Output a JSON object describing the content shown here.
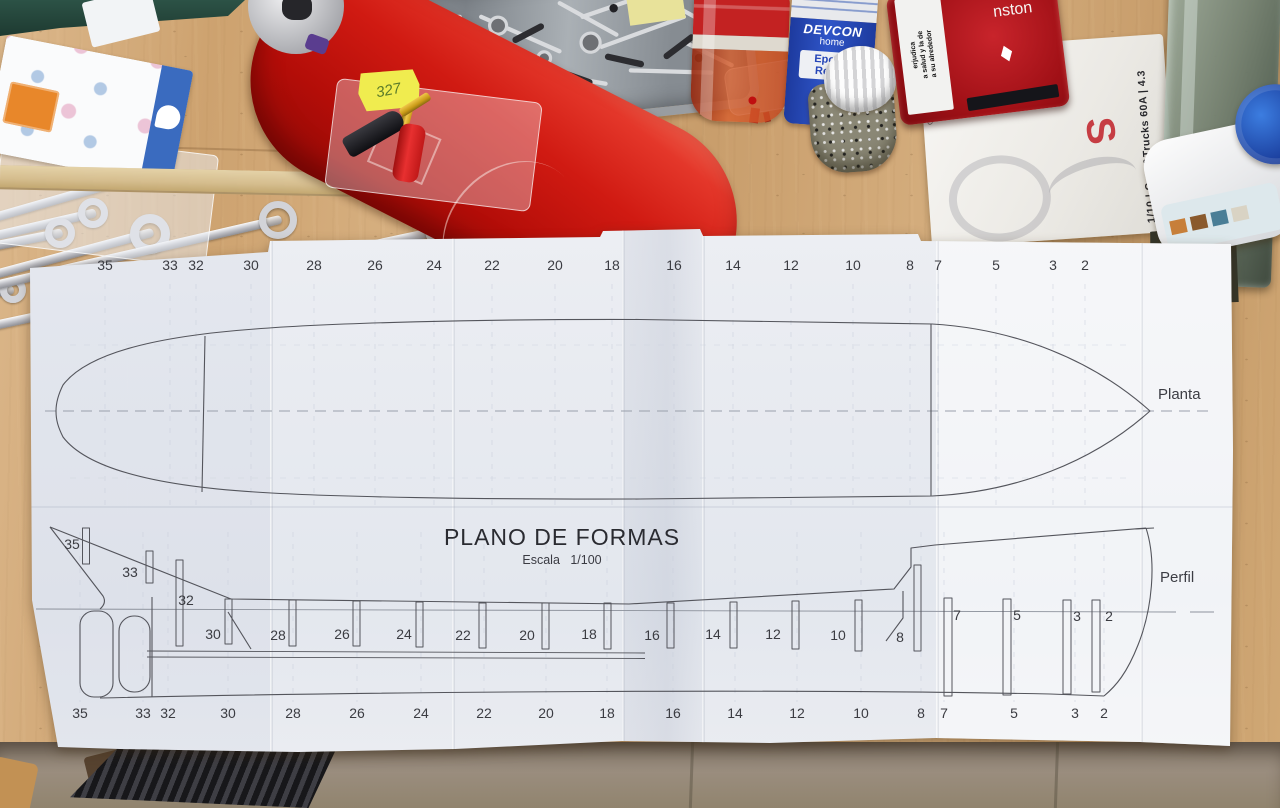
{
  "plan": {
    "title": "PLANO DE FORMAS",
    "scale_label": "Escala   1/100",
    "top_view_label": "Planta",
    "side_view_label": "Perfil",
    "stations": [
      "35",
      "33",
      "32",
      "30",
      "28",
      "26",
      "24",
      "22",
      "20",
      "18",
      "16",
      "14",
      "12",
      "10",
      "8",
      "7",
      "5",
      "3",
      "2"
    ]
  },
  "bench": {
    "sticky_note_text": "327",
    "epoxy_bottle": {
      "brand": "DEVCON",
      "line": "home",
      "product1": "Epoxy",
      "product2": "Resin"
    },
    "tobacco_tin": {
      "brand_fragment": "nston",
      "warning_line1": "erjudica",
      "warning_line2": "a salud y la de",
      "warning_line3": "a su alrededor"
    },
    "esc_box": {
      "side_text": "1/10 | Cars&Trucks 60A | 4.3",
      "logo_fragment": "S",
      "spec_line1": "Gewicht: 187g",
      "spec_line2": "2-3S LiPo"
    }
  },
  "colors": {
    "paper": "#e9ebf1",
    "drawing_line": "#54555c",
    "bench_wood": "#cfa571",
    "devcon_blue": "#2646b8",
    "tin_red": "#a81218",
    "sticky_yellow": "#f0ec4f",
    "glue_cap_blue": "#1b3f9e"
  }
}
